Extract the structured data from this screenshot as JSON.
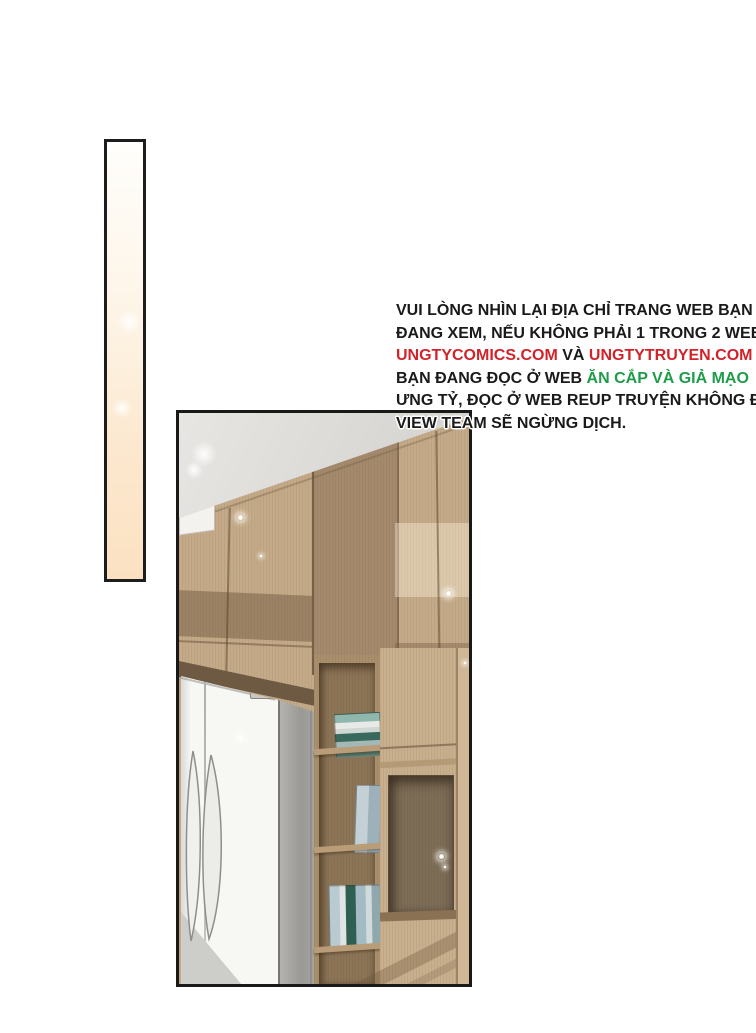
{
  "page": {
    "background_color": "#ffffff",
    "type_label": "comic translation credit page"
  },
  "decor_bar": {
    "border_color": "#1d1d1d",
    "gradient_top": "#fffefc",
    "gradient_bottom": "#fbe1c2"
  },
  "notice": {
    "text_color": "#1a1a1a",
    "url_color": "#d2232a",
    "warning_color": "#1f9c4a",
    "lines": [
      {
        "segments": [
          {
            "text": "VUI LÒNG NHÌN LẠI ĐỊA CHỈ TRANG WEB BẠN",
            "style": "black"
          }
        ]
      },
      {
        "segments": [
          {
            "text": "ĐANG XEM, NẾU KHÔNG PHẢI 1 TRONG 2 WEB",
            "style": "black"
          }
        ]
      },
      {
        "segments": [
          {
            "text": "UNGTYCOMICS.COM",
            "style": "red"
          },
          {
            "text": " VÀ ",
            "style": "black"
          },
          {
            "text": "UNGTYTRUYEN.COM",
            "style": "red"
          },
          {
            "text": " THÌ",
            "style": "black"
          }
        ]
      },
      {
        "segments": [
          {
            "text": "BẠN ĐANG ĐỌC Ở WEB ",
            "style": "black"
          },
          {
            "text": "ĂN CẮP VÀ GIẢ MẠO",
            "style": "green"
          }
        ]
      },
      {
        "segments": [
          {
            "text": "ƯNG TỶ, ĐỌC Ở WEB REUP TRUYỆN KHÔNG ĐỦ",
            "style": "black"
          }
        ]
      },
      {
        "segments": [
          {
            "text": "VIEW TEAM SẼ NGỪNG DỊCH.",
            "style": "black"
          }
        ]
      }
    ]
  },
  "panel": {
    "border_color": "#191919",
    "illustration": {
      "scene": "kitchen corner with wooden cabinets, grey ceiling, white double-door refrigerator and narrow bookshelf with books",
      "palette": {
        "ceiling_grey": "#d6d4d1",
        "wood_light": "#c4aa88",
        "wood_mid": "#aa8f6d",
        "wood_dark": "#7d6d57",
        "soffit_brown": "#6e5943",
        "fridge_white": "#f7f7f4",
        "fridge_side_grey": "#9a9996",
        "book_teal": "#8fb7ae",
        "book_dark_green": "#2f5f52",
        "book_blue_grey": "#b9cad1"
      }
    }
  }
}
